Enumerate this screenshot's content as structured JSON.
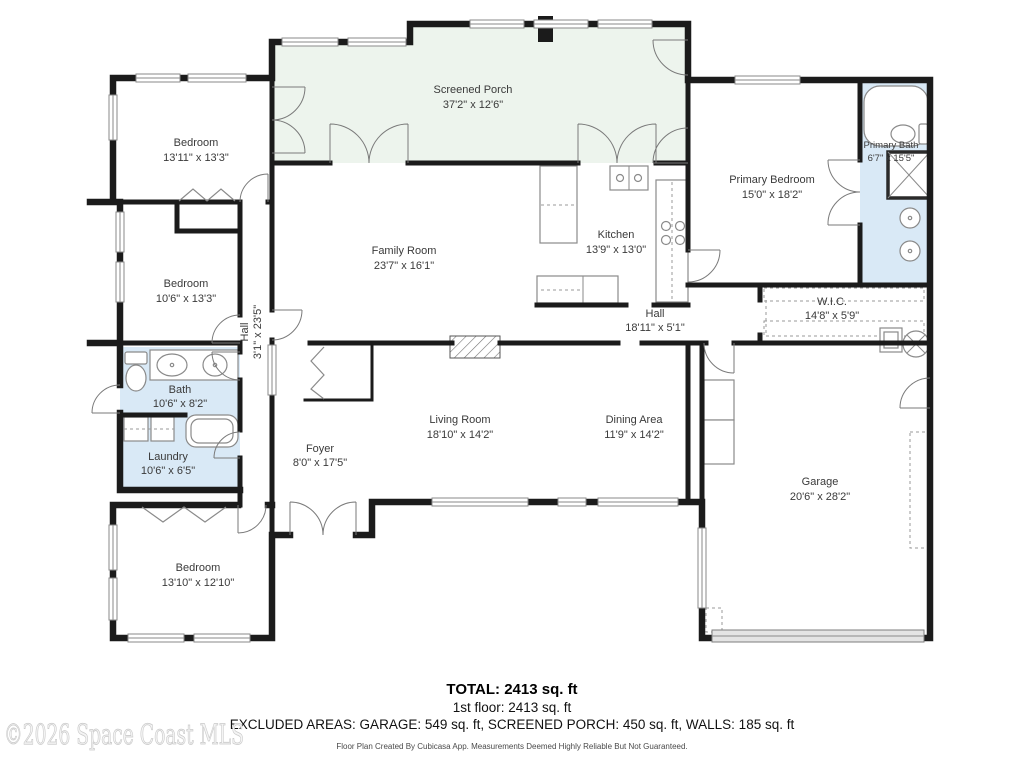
{
  "colors": {
    "wall": "#1b1b1b",
    "porch_fill": "#edf4ed",
    "bath_fill": "#d9e9f6",
    "label": "#3a3a3a",
    "garage_door_fill": "#e4e4e4",
    "watermark": "#e8e8e8"
  },
  "rooms": {
    "screened_porch": {
      "name": "Screened Porch",
      "dims": "37'2\" x 12'6\""
    },
    "bedroom_top_left": {
      "name": "Bedroom",
      "dims": "13'11\" x 13'3\""
    },
    "primary_bedroom": {
      "name": "Primary Bedroom",
      "dims": "15'0\" x 18'2\""
    },
    "primary_bath": {
      "name": "Primary Bath",
      "dims": "6'7\" x 15'5\""
    },
    "family_room": {
      "name": "Family Room",
      "dims": "23'7\" x 16'1\""
    },
    "kitchen": {
      "name": "Kitchen",
      "dims": "13'9\" x 13'0\""
    },
    "bedroom_left": {
      "name": "Bedroom",
      "dims": "10'6\" x 13'3\""
    },
    "hall_vertical": {
      "name": "Hall",
      "dims": "3'1\" x 23'5\""
    },
    "hall": {
      "name": "Hall",
      "dims": "18'11\" x 5'1\""
    },
    "wic": {
      "name": "W.I.C.",
      "dims": "14'8\" x 5'9\""
    },
    "bath": {
      "name": "Bath",
      "dims": "10'6\" x 8'2\""
    },
    "laundry": {
      "name": "Laundry",
      "dims": "10'6\" x 6'5\""
    },
    "living_room": {
      "name": "Living Room",
      "dims": "18'10\" x 14'2\""
    },
    "dining_area": {
      "name": "Dining Area",
      "dims": "11'9\" x 14'2\""
    },
    "foyer": {
      "name": "Foyer",
      "dims": "8'0\" x 17'5\""
    },
    "garage": {
      "name": "Garage",
      "dims": "20'6\" x 28'2\""
    },
    "bedroom_bottom": {
      "name": "Bedroom",
      "dims": "13'10\" x 12'10\""
    }
  },
  "footer": {
    "total": "TOTAL: 2413 sq. ft",
    "floor": "1st floor: 2413 sq. ft",
    "excluded": "EXCLUDED AREAS: GARAGE: 549 sq. ft, SCREENED PORCH: 450 sq. ft, WALLS: 185 sq. ft",
    "disclaimer": "Floor Plan Created By Cubicasa App. Measurements Deemed Highly Reliable But Not Guaranteed.",
    "watermark": "©2026 Space Coast MLS"
  }
}
